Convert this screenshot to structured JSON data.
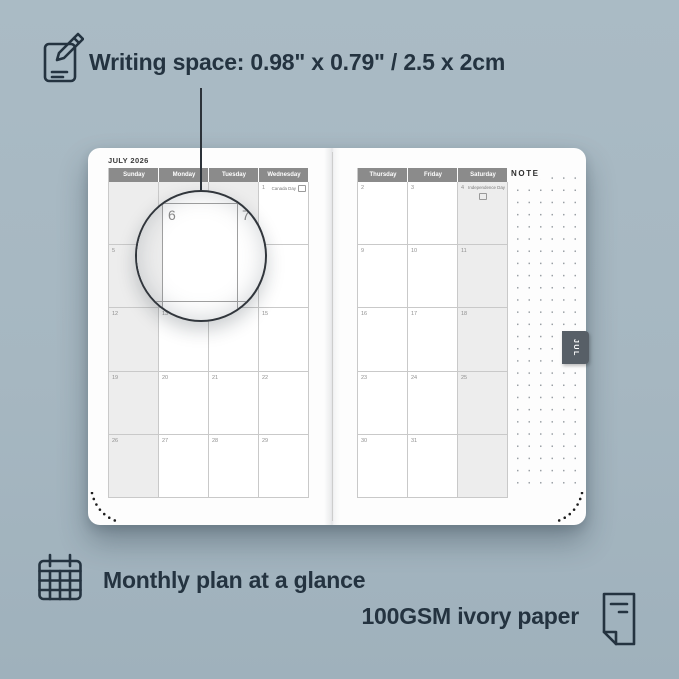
{
  "annotations": {
    "writing_space_label": "Writing space: 0.98\" x 0.79\" / 2.5 x 2cm",
    "monthly_plan_label": "Monthly plan at a glance",
    "paper_label": "100GSM ivory paper"
  },
  "colors": {
    "background": "#a6b7c1",
    "ink": "#243340",
    "weekday_header_bar": "#8b8b8b",
    "shaded_cell": "#ededed",
    "month_tab": "#575f67"
  },
  "planner": {
    "month_title": "JULY 2026",
    "side_tab": "JUL",
    "note_label": "NOTE",
    "fine_print": "· · · · ·",
    "left_page": {
      "day_headers": [
        "Sunday",
        "Monday",
        "Tuesday",
        "Wednesday"
      ],
      "weeks": [
        [
          "",
          "",
          "",
          "1"
        ],
        [
          "5",
          "6",
          "7",
          "8"
        ],
        [
          "12",
          "13",
          "14",
          "15"
        ],
        [
          "19",
          "20",
          "21",
          "22"
        ],
        [
          "26",
          "27",
          "28",
          "29"
        ]
      ],
      "shaded_column": 0,
      "extra_shaded_cells": [
        [
          0,
          1
        ],
        [
          0,
          2
        ]
      ],
      "holidays": [
        {
          "week": 0,
          "col": 3,
          "date": "1",
          "label": "Canada Day",
          "style": "inline",
          "icon": "canada-flag-icon"
        }
      ]
    },
    "right_page": {
      "day_headers": [
        "Thursday",
        "Friday",
        "Saturday"
      ],
      "weeks": [
        [
          "2",
          "3",
          "4"
        ],
        [
          "9",
          "10",
          "11"
        ],
        [
          "16",
          "17",
          "18"
        ],
        [
          "23",
          "24",
          "25"
        ],
        [
          "30",
          "31",
          ""
        ]
      ],
      "shaded_column": 2,
      "extra_shaded_cells": [],
      "holidays": [
        {
          "week": 0,
          "col": 2,
          "date": "4",
          "label": "Independence Day",
          "style": "stacked",
          "icon": "us-flag-icon"
        }
      ]
    },
    "magnifier": {
      "primary_date": "6",
      "adjacent_date": "7"
    }
  }
}
